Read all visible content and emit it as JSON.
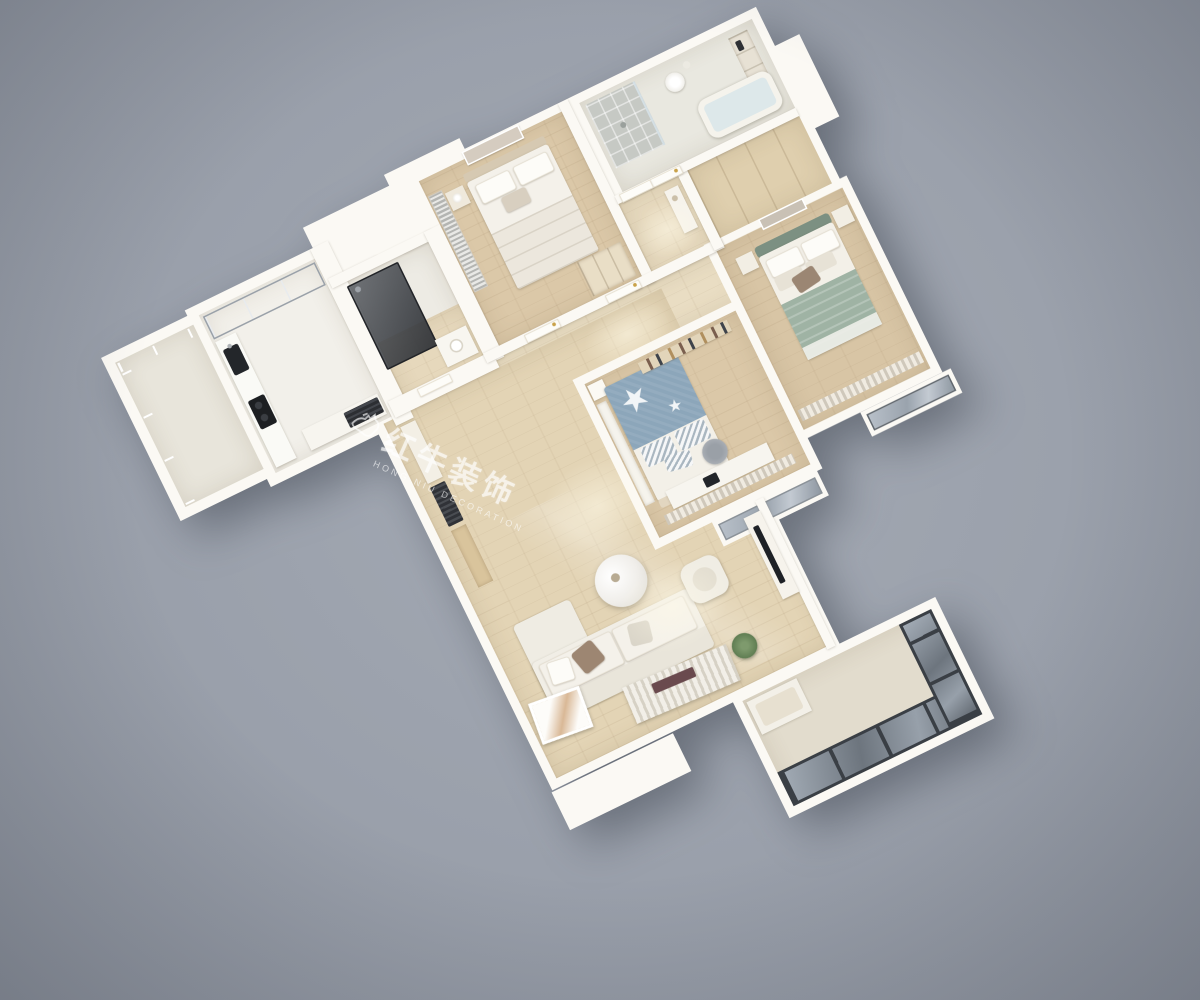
{
  "scene": {
    "type": "3d-apartment-floorplan-render",
    "view": "top-down isometric cutaway",
    "watermark": {
      "logo": "bull-logo",
      "title_cn": "红牛装饰",
      "subtitle_en": "HONG NIU DECORATION"
    },
    "palette": {
      "background_gray": "#9aa0ab",
      "wall_white": "#fbf9f4",
      "wall_cream": "#efe8d8",
      "floor_wood": "#dbc8a8",
      "floor_wood_light": "#e8dcc2",
      "floor_tile": "#f2f0ea",
      "glass_gray": "#a8b1bb",
      "frame_dark": "#3a3f45",
      "blanket_blue": "#8ca6ba",
      "blanket_sage": "#9fb3a4",
      "headboard_sage": "#7c9082",
      "pillow_brown": "#9b8673",
      "appliance_black": "#24262a"
    },
    "rooms": [
      {
        "name": "kitchen-balcony",
        "contents": [
          "glazed-gray-windows"
        ]
      },
      {
        "name": "kitchen",
        "contents": [
          "glass-front-cabinet",
          "counter",
          "black-sink",
          "black-cooktop",
          "island-counter"
        ]
      },
      {
        "name": "guest-shower-room",
        "contents": [
          "smoked-glass-shower",
          "vanity-basin"
        ]
      },
      {
        "name": "secondary-bedroom",
        "contents": [
          "double-bed",
          "nightstand",
          "table-lamp",
          "wall-art",
          "wardrobe",
          "window-blinds"
        ]
      },
      {
        "name": "main-bathroom",
        "contents": [
          "shower-stall",
          "pedestal-sink",
          "niche-shelves",
          "bathtub"
        ]
      },
      {
        "name": "entry-hall",
        "contents": [
          "console-table",
          "panel-doors"
        ]
      },
      {
        "name": "closet-corridor",
        "contents": [
          "built-in-wardrobe"
        ]
      },
      {
        "name": "master-bedroom",
        "contents": [
          "double-bed-sage-blanket",
          "two-nightstands",
          "wall-art",
          "striped-curtains",
          "bay-window"
        ]
      },
      {
        "name": "kids-bedroom",
        "contents": [
          "bed-blue-star-blanket",
          "striped-pillows",
          "desk",
          "desk-chair",
          "monitor",
          "wall-shelf-books",
          "curtains",
          "window-seat"
        ]
      },
      {
        "name": "dining-area",
        "contents": [
          "white-dining-table",
          "four-chairs",
          "plant-centerpiece"
        ]
      },
      {
        "name": "living-room",
        "contents": [
          "sectional-sofa",
          "throw-pillows",
          "round-marble-coffee-table",
          "armchair",
          "tv-console",
          "leaning-artwork",
          "slatted-shelf",
          "plant"
        ]
      },
      {
        "name": "main-balcony",
        "contents": [
          "dark-frame-floor-windows",
          "bench"
        ]
      }
    ]
  }
}
